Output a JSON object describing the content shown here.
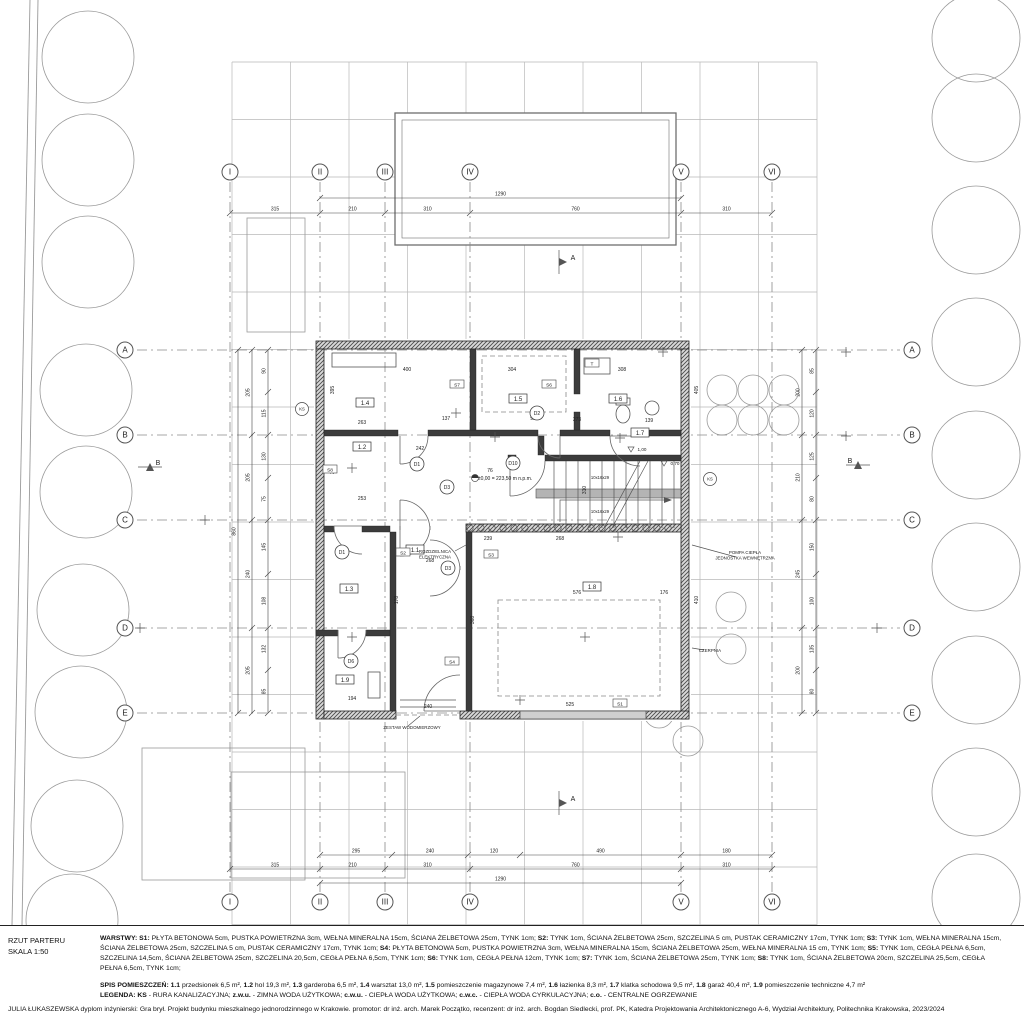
{
  "title_block": {
    "drawing_title": "RZUT PARTERU",
    "scale": "SKALA 1:50",
    "warstwy": [
      {
        "t": "WARSTWY: ",
        "b": 1
      },
      {
        "t": "S1: ",
        "b": 1
      },
      {
        "t": "PŁYTA BETONOWA 5cm, PUSTKA POWIETRZNA 3cm, WEŁNA MINERALNA 15cm, ŚCIANA ŻELBETOWA 25cm, TYNK 1cm; ",
        "b": 0
      },
      {
        "t": "S2: ",
        "b": 1
      },
      {
        "t": "TYNK 1cm, ŚCIANA ŻELBETOWA 25cm, SZCZELINA 5 cm, PUSTAK CERAMICZNY 17cm, TYNK 1cm; ",
        "b": 0
      },
      {
        "t": "S3: ",
        "b": 1
      },
      {
        "t": "TYNK 1cm, WEŁNA MINERALNA 15cm, ŚCIANA ŻELBETOWA 25cm, SZCZELINA 5 cm, PUSTAK CERAMICZNY 17cm, TYNK 1cm; ",
        "b": 0
      },
      {
        "t": "S4: ",
        "b": 1
      },
      {
        "t": "PŁYTA BETONOWA 5cm, PUSTKA POWIETRZNA 3cm, WEŁNA MINERALNA 15cm, ŚCIANA ŻELBETOWA 25cm, WEŁNA MINERALNA 15 cm, TYNK 1cm; ",
        "b": 0
      },
      {
        "t": "S5: ",
        "b": 1
      },
      {
        "t": "TYNK 1cm, CEGŁA PEŁNA 6,5cm, SZCZELINA 14,5cm, ŚCIANA ŻELBETOWA 25cm, SZCZELINA 20,5cm, CEGŁA PEŁNA 6,5cm, TYNK 1cm; ",
        "b": 0
      },
      {
        "t": "S6: ",
        "b": 1
      },
      {
        "t": "TYNK 1cm, CEGŁA PEŁNA 12cm, TYNK 1cm; ",
        "b": 0
      },
      {
        "t": "S7: ",
        "b": 1
      },
      {
        "t": "TYNK 1cm, ŚCIANA ŻELBETOWA 25cm, TYNK 1cm; ",
        "b": 0
      },
      {
        "t": "S8: ",
        "b": 1
      },
      {
        "t": "TYNK 1cm, ŚCIANA ŻELBETOWA 20cm, SZCZELINA 25,5cm, CEGŁA PEŁNA 6,5cm, TYNK 1cm;",
        "b": 0
      }
    ],
    "spis": [
      {
        "t": "SPIS POMIESZCZEŃ: ",
        "b": 1
      },
      {
        "t": "1.1 ",
        "b": 1
      },
      {
        "t": "przedsionek 6,5 m², ",
        "b": 0
      },
      {
        "t": "1.2 ",
        "b": 1
      },
      {
        "t": "hol 19,3 m², ",
        "b": 0
      },
      {
        "t": "1.3 ",
        "b": 1
      },
      {
        "t": "garderoba 6,5 m², ",
        "b": 0
      },
      {
        "t": "1.4 ",
        "b": 1
      },
      {
        "t": "warsztat 13,0 m², ",
        "b": 0
      },
      {
        "t": "1.5 ",
        "b": 1
      },
      {
        "t": "pomieszczenie magazynowe 7,4 m², ",
        "b": 0
      },
      {
        "t": "1.6 ",
        "b": 1
      },
      {
        "t": "łazienka 8,3 m², ",
        "b": 0
      },
      {
        "t": "1.7 ",
        "b": 1
      },
      {
        "t": "klatka schodowa 9,5 m², ",
        "b": 0
      },
      {
        "t": "1.8 ",
        "b": 1
      },
      {
        "t": "garaż 40,4 m², ",
        "b": 0
      },
      {
        "t": "1.9 ",
        "b": 1
      },
      {
        "t": "pomieszczenie techniczne 4,7 m²",
        "b": 0
      }
    ],
    "legenda": [
      {
        "t": "LEGENDA: KS",
        "b": 1
      },
      {
        "t": " - RURA KANALIZACYJNA; ",
        "b": 0
      },
      {
        "t": "z.w.u.",
        "b": 1
      },
      {
        "t": " - ZIMNA WODA UŻYTKOWA; ",
        "b": 0
      },
      {
        "t": "c.w.u.",
        "b": 1
      },
      {
        "t": " - CIEPŁA WODA UŻYTKOWA; ",
        "b": 0
      },
      {
        "t": "c.w.c.",
        "b": 1
      },
      {
        "t": " - CIEPŁA WODA CYRKULACYJNA; ",
        "b": 0
      },
      {
        "t": "c.o.",
        "b": 1
      },
      {
        "t": " - CENTRALNE OGRZEWANIE",
        "b": 0
      }
    ],
    "credits": "JULIA ŁUKASZEWSKA dyplom inżynierski: Gra brył. Projekt budynku mieszkalnego jednorodzinnego w Krakowie. promotor: dr inż. arch. Marek Początko, recenzent: dr inż. arch. Bogdan Siedlecki, prof. PK, Katedra Projektowania Architektonicznego A-6, Wydział Architektury, Politechnika Krakowska, 2023/2024"
  },
  "drawing": {
    "grid": {
      "cols": [
        {
          "label": "I",
          "x": 230
        },
        {
          "label": "II",
          "x": 320
        },
        {
          "label": "III",
          "x": 385
        },
        {
          "label": "IV",
          "x": 470
        },
        {
          "label": "V",
          "x": 681
        },
        {
          "label": "VI",
          "x": 772
        }
      ],
      "rows": [
        {
          "label": "A",
          "y": 350
        },
        {
          "label": "B",
          "y": 435
        },
        {
          "label": "C",
          "y": 520
        },
        {
          "label": "D",
          "y": 628
        },
        {
          "label": "E",
          "y": 713
        }
      ]
    },
    "section_markers": [
      {
        "label": "A",
        "x": 565,
        "y": 262,
        "dir": "down"
      },
      {
        "label": "A",
        "x": 565,
        "y": 803,
        "dir": "up"
      },
      {
        "label": "B",
        "x": 150,
        "y": 463,
        "dir": "right"
      },
      {
        "label": "B",
        "x": 858,
        "y": 461,
        "dir": "left"
      }
    ],
    "dims": {
      "top_total": "1290",
      "top_chain": [
        "315",
        "210",
        "310",
        "760",
        "310"
      ],
      "bottom_chain1": [
        "295",
        "240",
        "120",
        "490",
        "180"
      ],
      "bottom_chain2": [
        "315",
        "210",
        "310",
        "760",
        "310"
      ],
      "bottom_total": "1290",
      "left_chain": [
        "205",
        "205",
        "240",
        "205"
      ],
      "left_total": "860",
      "left_inner": [
        "90",
        "115",
        "130",
        "75",
        "145",
        "108",
        "132",
        "85"
      ],
      "right_chain": [
        "200",
        "210",
        "245",
        "200"
      ],
      "right_inner": [
        "85",
        "120",
        "125",
        "80",
        "150",
        "100",
        "135",
        "80"
      ],
      "interior": [
        {
          "x": 407,
          "y": 371,
          "t": "400"
        },
        {
          "x": 512,
          "y": 371,
          "t": "304"
        },
        {
          "x": 622,
          "y": 371,
          "t": "308"
        },
        {
          "x": 362,
          "y": 424,
          "t": "263"
        },
        {
          "x": 446,
          "y": 420,
          "t": "137"
        },
        {
          "x": 533,
          "y": 420,
          "t": "98"
        },
        {
          "x": 577,
          "y": 421,
          "t": "273"
        },
        {
          "x": 649,
          "y": 422,
          "t": "139"
        },
        {
          "x": 420,
          "y": 450,
          "t": "242"
        },
        {
          "x": 490,
          "y": 472,
          "t": "76"
        },
        {
          "x": 362,
          "y": 500,
          "t": "253"
        },
        {
          "x": 430,
          "y": 562,
          "t": "268"
        },
        {
          "x": 352,
          "y": 700,
          "t": "194"
        },
        {
          "x": 428,
          "y": 708,
          "t": "240"
        },
        {
          "x": 577,
          "y": 594,
          "t": "576"
        },
        {
          "x": 570,
          "y": 706,
          "t": "525"
        },
        {
          "x": 664,
          "y": 594,
          "t": "176"
        },
        {
          "x": 560,
          "y": 540,
          "t": "268"
        },
        {
          "x": 488,
          "y": 540,
          "t": "239"
        },
        {
          "x": 334,
          "y": 390,
          "t": "395",
          "r": 1
        },
        {
          "x": 334,
          "y": 470,
          "t": "345",
          "r": 1
        },
        {
          "x": 698,
          "y": 390,
          "t": "405",
          "r": 1
        },
        {
          "x": 698,
          "y": 600,
          "t": "410",
          "r": 1
        },
        {
          "x": 474,
          "y": 620,
          "t": "368",
          "r": 1
        },
        {
          "x": 398,
          "y": 600,
          "t": "178",
          "r": 1
        },
        {
          "x": 586,
          "y": 490,
          "t": "310",
          "r": 1
        }
      ]
    },
    "rooms": [
      {
        "id": "1.4",
        "x": 365,
        "y": 404
      },
      {
        "id": "1.5",
        "x": 518,
        "y": 400
      },
      {
        "id": "1.6",
        "x": 618,
        "y": 400
      },
      {
        "id": "1.2",
        "x": 362,
        "y": 448
      },
      {
        "id": "1.7",
        "x": 640,
        "y": 434
      },
      {
        "id": "1.1",
        "x": 415,
        "y": 551
      },
      {
        "id": "1.3",
        "x": 349,
        "y": 590
      },
      {
        "id": "1.8",
        "x": 592,
        "y": 588
      },
      {
        "id": "1.9",
        "x": 345,
        "y": 681
      }
    ],
    "doors": [
      {
        "id": "D1",
        "x": 417,
        "y": 464
      },
      {
        "id": "D10",
        "x": 513,
        "y": 463
      },
      {
        "id": "D2",
        "x": 537,
        "y": 413
      },
      {
        "id": "D3",
        "x": 447,
        "y": 487
      },
      {
        "id": "D3",
        "x": 448,
        "y": 568
      },
      {
        "id": "D1",
        "x": 342,
        "y": 552
      },
      {
        "id": "D6",
        "x": 351,
        "y": 661
      }
    ],
    "wall_tags": [
      {
        "t": "S7",
        "x": 457,
        "y": 385
      },
      {
        "t": "S6",
        "x": 549,
        "y": 385
      },
      {
        "t": "T",
        "x": 592,
        "y": 364
      },
      {
        "t": "S2",
        "x": 403,
        "y": 553
      },
      {
        "t": "S3",
        "x": 491,
        "y": 555
      },
      {
        "t": "S4",
        "x": 452,
        "y": 662
      },
      {
        "t": "S1",
        "x": 620,
        "y": 704
      },
      {
        "t": "S8",
        "x": 330,
        "y": 470
      }
    ],
    "ks_markers": [
      {
        "t": "KS",
        "x": 302,
        "y": 409
      },
      {
        "t": "KS",
        "x": 710,
        "y": 479
      }
    ],
    "annotations": [
      {
        "lines": [
          "ROZDZIELNICA",
          "ELEKTRYCZNA"
        ],
        "x": 435,
        "y": 553
      },
      {
        "lines": [
          "POMPA CIEPŁA",
          "JEDNOSTKA WEWNĘTRZNA"
        ],
        "x": 745,
        "y": 554
      },
      {
        "lines": [
          "ZESTAW WODOMIERZOWY"
        ],
        "x": 412,
        "y": 729
      },
      {
        "lines": [
          "CZERPNIA"
        ],
        "x": 710,
        "y": 652
      }
    ],
    "elevation": {
      "t": "±0,00 = 223,50 m n.p.m.",
      "x": 497,
      "y": 480
    },
    "levels": [
      {
        "t": "1,00",
        "x": 636,
        "y": 452
      },
      {
        "t": "0,70",
        "x": 669,
        "y": 466
      }
    ],
    "stair_texts": [
      {
        "t": "10x16x29",
        "x": 600,
        "y": 479
      },
      {
        "t": "10x16x29",
        "x": 600,
        "y": 513
      }
    ]
  }
}
